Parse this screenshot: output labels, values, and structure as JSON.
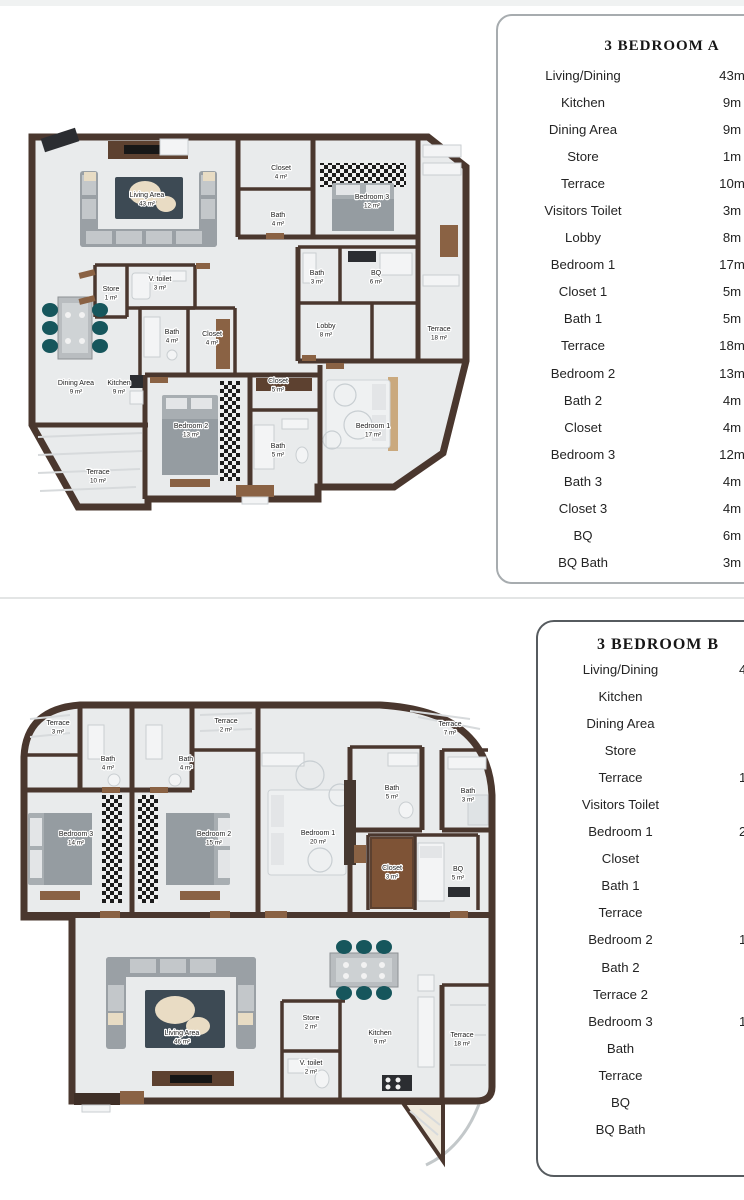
{
  "colors": {
    "wall": "#4a372e",
    "wood": "#8a6244",
    "floor": "#e9ebec",
    "teal": "#16565c",
    "rug": "#3d4a54"
  },
  "plan_a": {
    "table": {
      "title": "3 BEDROOM A",
      "rows": [
        {
          "label": "Living/Dining",
          "value": "43m"
        },
        {
          "label": "Kitchen",
          "value": "9m"
        },
        {
          "label": "Dining Area",
          "value": "9m"
        },
        {
          "label": "Store",
          "value": "1m"
        },
        {
          "label": "Terrace",
          "value": "10m"
        },
        {
          "label": "Visitors Toilet",
          "value": "3m"
        },
        {
          "label": "Lobby",
          "value": "8m"
        },
        {
          "label": "Bedroom 1",
          "value": "17m"
        },
        {
          "label": "Closet 1",
          "value": "5m"
        },
        {
          "label": "Bath 1",
          "value": "5m"
        },
        {
          "label": "Terrace",
          "value": "18m"
        },
        {
          "label": "Bedroom 2",
          "value": "13m"
        },
        {
          "label": "Bath 2",
          "value": "4m"
        },
        {
          "label": "Closet",
          "value": "4m"
        },
        {
          "label": "Bedroom 3",
          "value": "12m"
        },
        {
          "label": "Bath 3",
          "value": "4m"
        },
        {
          "label": "Closet 3",
          "value": "4m"
        },
        {
          "label": "BQ",
          "value": "6m"
        },
        {
          "label": "BQ Bath",
          "value": "3m"
        }
      ]
    },
    "labels": [
      {
        "name": "Living Area",
        "area": "43 m²",
        "x": 127,
        "y": 72
      },
      {
        "name": "Closet",
        "area": "4 m²",
        "x": 261,
        "y": 45
      },
      {
        "name": "Bedroom 3",
        "area": "12 m²",
        "x": 352,
        "y": 74
      },
      {
        "name": "Bath",
        "area": "4 m²",
        "x": 258,
        "y": 92
      },
      {
        "name": "Store",
        "area": "1 m²",
        "x": 91,
        "y": 166
      },
      {
        "name": "V. toilet",
        "area": "3 m²",
        "x": 140,
        "y": 156
      },
      {
        "name": "Bath",
        "area": "4 m²",
        "x": 152,
        "y": 209
      },
      {
        "name": "Closet",
        "area": "4 m²",
        "x": 192,
        "y": 211
      },
      {
        "name": "Bath",
        "area": "3 m²",
        "x": 297,
        "y": 150
      },
      {
        "name": "BQ",
        "area": "6 m²",
        "x": 356,
        "y": 150
      },
      {
        "name": "Lobby",
        "area": "8 m²",
        "x": 306,
        "y": 203
      },
      {
        "name": "Terrace",
        "area": "18 m²",
        "x": 419,
        "y": 206
      },
      {
        "name": "Dining Area",
        "area": "9 m²",
        "x": 56,
        "y": 260
      },
      {
        "name": "Kitchen",
        "area": "9 m²",
        "x": 99,
        "y": 260
      },
      {
        "name": "Closet",
        "area": "5 m²",
        "x": 258,
        "y": 258
      },
      {
        "name": "Bedroom 2",
        "area": "13 m²",
        "x": 171,
        "y": 303
      },
      {
        "name": "Bath",
        "area": "5 m²",
        "x": 258,
        "y": 323
      },
      {
        "name": "Bedroom 1",
        "area": "17 m²",
        "x": 353,
        "y": 303
      },
      {
        "name": "Terrace",
        "area": "10 m²",
        "x": 78,
        "y": 349
      }
    ]
  },
  "plan_b": {
    "table": {
      "title": "3 BEDROOM B",
      "rows": [
        {
          "label": "Living/Dining",
          "value": "4"
        },
        {
          "label": "Kitchen",
          "value": ""
        },
        {
          "label": "Dining Area",
          "value": ""
        },
        {
          "label": "Store",
          "value": ""
        },
        {
          "label": "Terrace",
          "value": "1"
        },
        {
          "label": "Visitors Toilet",
          "value": ""
        },
        {
          "label": "Bedroom 1",
          "value": "2"
        },
        {
          "label": "Closet",
          "value": ""
        },
        {
          "label": "Bath 1",
          "value": ""
        },
        {
          "label": "Terrace",
          "value": ""
        },
        {
          "label": "Bedroom 2",
          "value": "1"
        },
        {
          "label": "Bath 2",
          "value": ""
        },
        {
          "label": "Terrace 2",
          "value": ""
        },
        {
          "label": "Bedroom 3",
          "value": "1"
        },
        {
          "label": "Bath",
          "value": ""
        },
        {
          "label": "Terrace",
          "value": ""
        },
        {
          "label": "BQ",
          "value": ""
        },
        {
          "label": "BQ Bath",
          "value": ""
        }
      ]
    },
    "labels": [
      {
        "name": "Terrace",
        "area": "3 m²",
        "x": 48,
        "y": 30
      },
      {
        "name": "Bath",
        "area": "4 m²",
        "x": 98,
        "y": 66
      },
      {
        "name": "Bath",
        "area": "4 m²",
        "x": 176,
        "y": 66
      },
      {
        "name": "Terrace",
        "area": "2 m²",
        "x": 216,
        "y": 28
      },
      {
        "name": "Bedroom 3",
        "area": "14 m²",
        "x": 66,
        "y": 141
      },
      {
        "name": "Bedroom 2",
        "area": "15 m²",
        "x": 204,
        "y": 141
      },
      {
        "name": "Bedroom 1",
        "area": "20 m²",
        "x": 308,
        "y": 140
      },
      {
        "name": "Terrace",
        "area": "7 m²",
        "x": 440,
        "y": 31
      },
      {
        "name": "Bath",
        "area": "5 m²",
        "x": 382,
        "y": 95
      },
      {
        "name": "Bath",
        "area": "3 m²",
        "x": 458,
        "y": 98
      },
      {
        "name": "Closet",
        "area": "3 m²",
        "x": 382,
        "y": 175
      },
      {
        "name": "BQ",
        "area": "5 m²",
        "x": 448,
        "y": 176
      },
      {
        "name": "Living Area",
        "area": "46 m²",
        "x": 172,
        "y": 340
      },
      {
        "name": "Store",
        "area": "2 m²",
        "x": 301,
        "y": 325
      },
      {
        "name": "V. toilet",
        "area": "2 m²",
        "x": 301,
        "y": 370
      },
      {
        "name": "Kitchen",
        "area": "9 m²",
        "x": 370,
        "y": 340
      },
      {
        "name": "Terrace",
        "area": "18 m²",
        "x": 452,
        "y": 342
      }
    ]
  }
}
